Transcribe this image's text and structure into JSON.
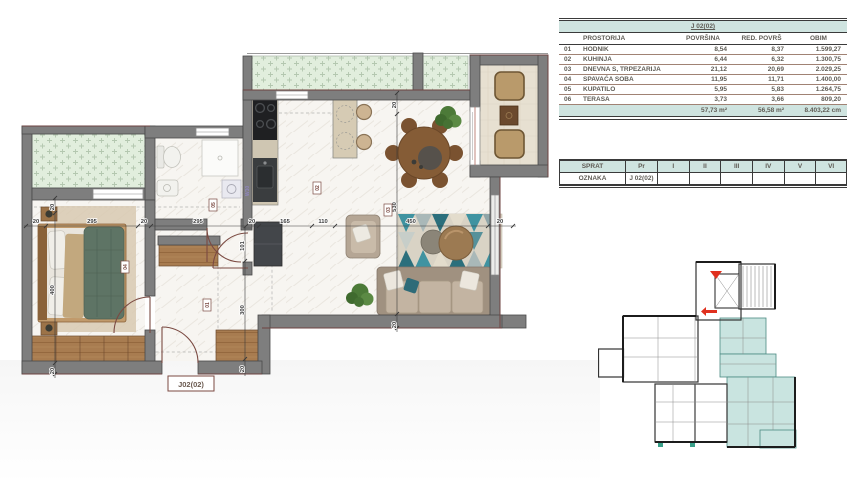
{
  "area_table": {
    "title": "J 02(02)",
    "headers": {
      "name": "PROSTORIJA",
      "a": "POVRŠINA",
      "b": "RED. POVRŠ",
      "c": "OBIM"
    },
    "rows": [
      {
        "num": "01",
        "name": "HODNIK",
        "a": "8,54",
        "b": "8,37",
        "c": "1.599,27"
      },
      {
        "num": "02",
        "name": "KUHINJA",
        "a": "6,44",
        "b": "6,32",
        "c": "1.300,75"
      },
      {
        "num": "03",
        "name": "DNEVNA S, TRPEZARIJA",
        "a": "21,12",
        "b": "20,69",
        "c": "2.029,25"
      },
      {
        "num": "04",
        "name": "SPAVAĆA SOBA",
        "a": "11,95",
        "b": "11,71",
        "c": "1.400,00"
      },
      {
        "num": "05",
        "name": "KUPATILO",
        "a": "5,95",
        "b": "5,83",
        "c": "1.264,75"
      },
      {
        "num": "06",
        "name": "TERASA",
        "a": "3,73",
        "b": "3,66",
        "c": "809,20"
      }
    ],
    "totals": {
      "a": "57,73 m²",
      "b": "56,58 m²",
      "c": "8.403,22 cm"
    }
  },
  "floor_table": {
    "headers": [
      "SPRAT",
      "Pr",
      "I",
      "II",
      "III",
      "IV",
      "V",
      "VI"
    ],
    "row_label": "OZNAKA",
    "values": [
      "J 02(02)",
      "",
      "",
      "",
      "",
      "",
      ""
    ]
  },
  "plan": {
    "unit_label": "J02(02)",
    "dim_h": [
      "20",
      "295",
      "20",
      "295",
      "20",
      "165",
      "110",
      "450",
      "20"
    ],
    "dim_v_left": [
      "20",
      "400",
      "20"
    ],
    "dim_v_mid": [
      "101",
      "300",
      "20"
    ],
    "dim_v_right": [
      "20",
      "530",
      "20"
    ],
    "room_numbers": [
      "01",
      "02",
      "03",
      "04",
      "05"
    ],
    "washer_label": "W30"
  },
  "colors": {
    "wall": "#7e7e7e",
    "wall_edge": "#4a4a4a",
    "accent_maroon": "#6e4340",
    "table_band": "#cfe4e0",
    "balcony_mint": "#e1eedd",
    "highlight_teal": "#c9e4e0",
    "marker_red": "#e0301e"
  }
}
